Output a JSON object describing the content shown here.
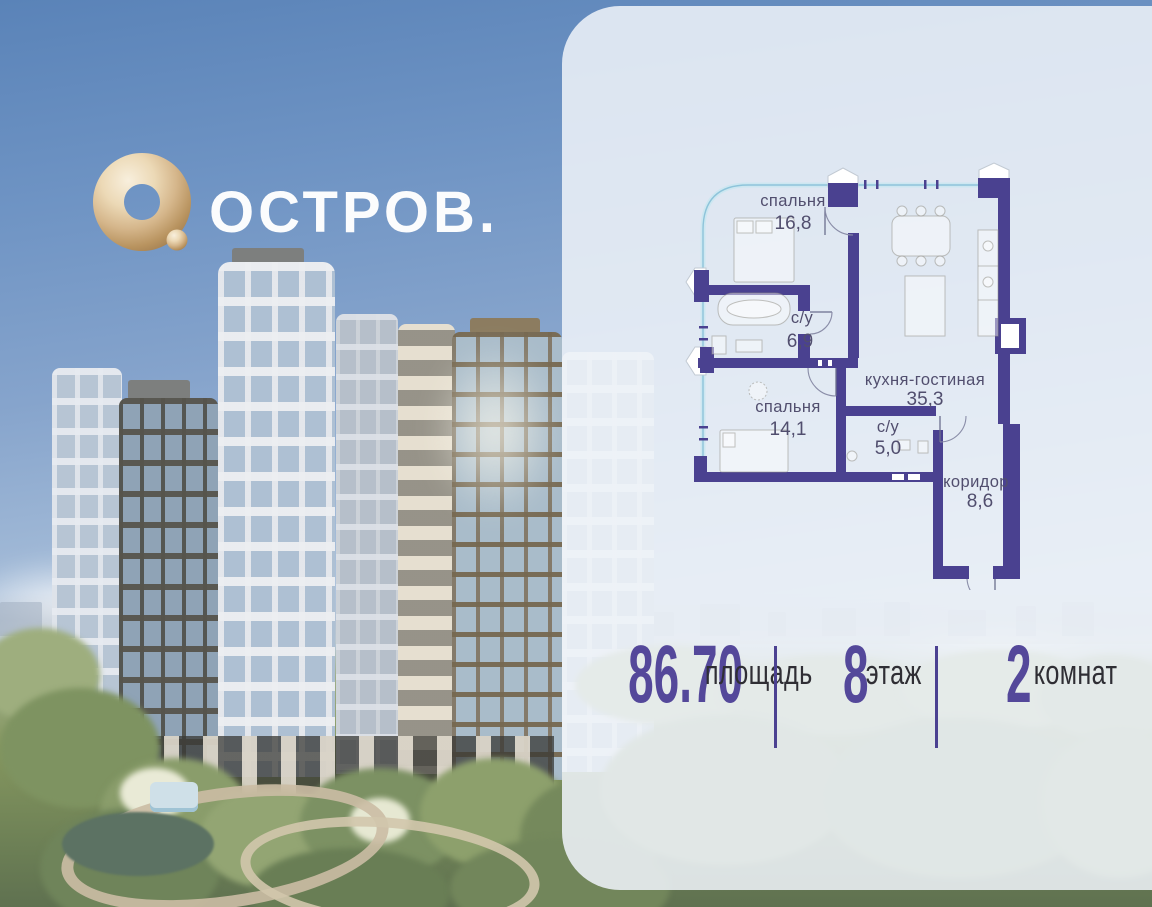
{
  "brand": {
    "name": "ОСТРОВ."
  },
  "floor_plan": {
    "rooms": [
      {
        "name": "спальня",
        "area": "16,8"
      },
      {
        "name": "с/у",
        "area": "6,9"
      },
      {
        "name": "кухня-гостиная",
        "area": "35,3"
      },
      {
        "name": "спальня",
        "area": "14,1"
      },
      {
        "name": "с/у",
        "area": "5,0"
      },
      {
        "name": "коридор",
        "area": "8,6"
      }
    ]
  },
  "stats": {
    "area": {
      "value": "86.70",
      "label": "площадь"
    },
    "floor": {
      "value": "8",
      "label": "этаж"
    },
    "rooms": {
      "value": "2",
      "label": "комнат"
    }
  },
  "colors": {
    "plan_wall": "#4a4190",
    "window_line": "#8ec4da",
    "stat_number": "#54489a",
    "stat_label": "#2f2e34",
    "room_label": "#514e6e",
    "logo_gold": "#cfae83",
    "panel": "#eef2f8",
    "sky": "#6f94c4"
  }
}
